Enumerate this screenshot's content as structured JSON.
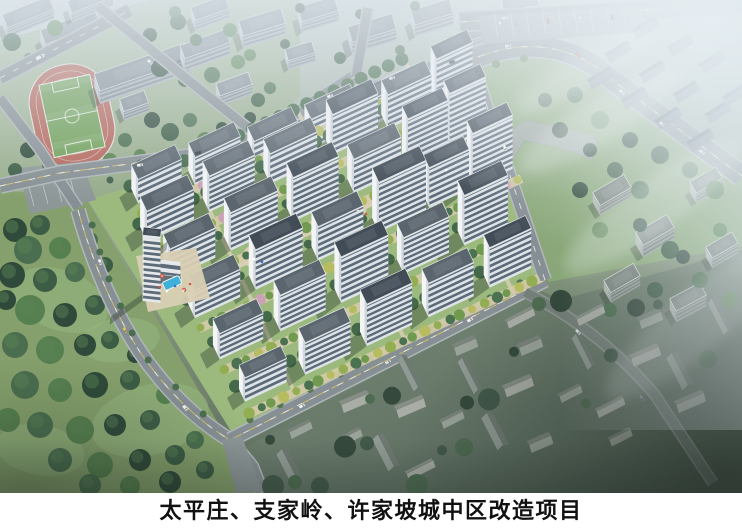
{
  "caption": {
    "text": "太平庄、支家岭、许家坡城中区改造项目"
  },
  "palette": {
    "caption_background": "#ffffff",
    "caption_text": "#111111",
    "haze": "#e2eaf0",
    "road_gray": "#868f94",
    "road_curb": "#b0b7bb",
    "lane_yellow": "#d9c46a",
    "lane_white": "#f2f4f5",
    "facade_white": "#e9edf0",
    "facade_gable": "#f2f4f6",
    "window_band": "rgba(60,76,94,0.8)",
    "roof_dark": "#414c57",
    "roof_light": "#5b656e",
    "context_facade": "#a9b3b9",
    "context_gable": "#c3cbd0",
    "context_roof": "#828d94",
    "track_red": "#b4675b",
    "pitch_green": "#6f9f58",
    "lawn": "#8fae77",
    "park_lawn": "#85a06c",
    "complex_lawn": "#9cb97e",
    "east_lawn": "#8aa878",
    "tree_dark": "#3c5a46",
    "tree_mid": "#4a7150",
    "tree_light": "#6f9a4f",
    "tree_yellow": "#b7bc60",
    "blossom_pink": "#c9a2b5",
    "deck_tan": "#d5cbaa",
    "path_beige": "#d9cfb4",
    "plaza_gray": "#8d9798",
    "pool_blue": "#3fb0d8",
    "village_roof_light": "#9aa399",
    "village_roof_dark": "#7b847c",
    "ne_roof_light": "#79848f",
    "ne_roof_dark": "#5f6a76",
    "shadow": "rgba(42,58,47,0.38)"
  }
}
